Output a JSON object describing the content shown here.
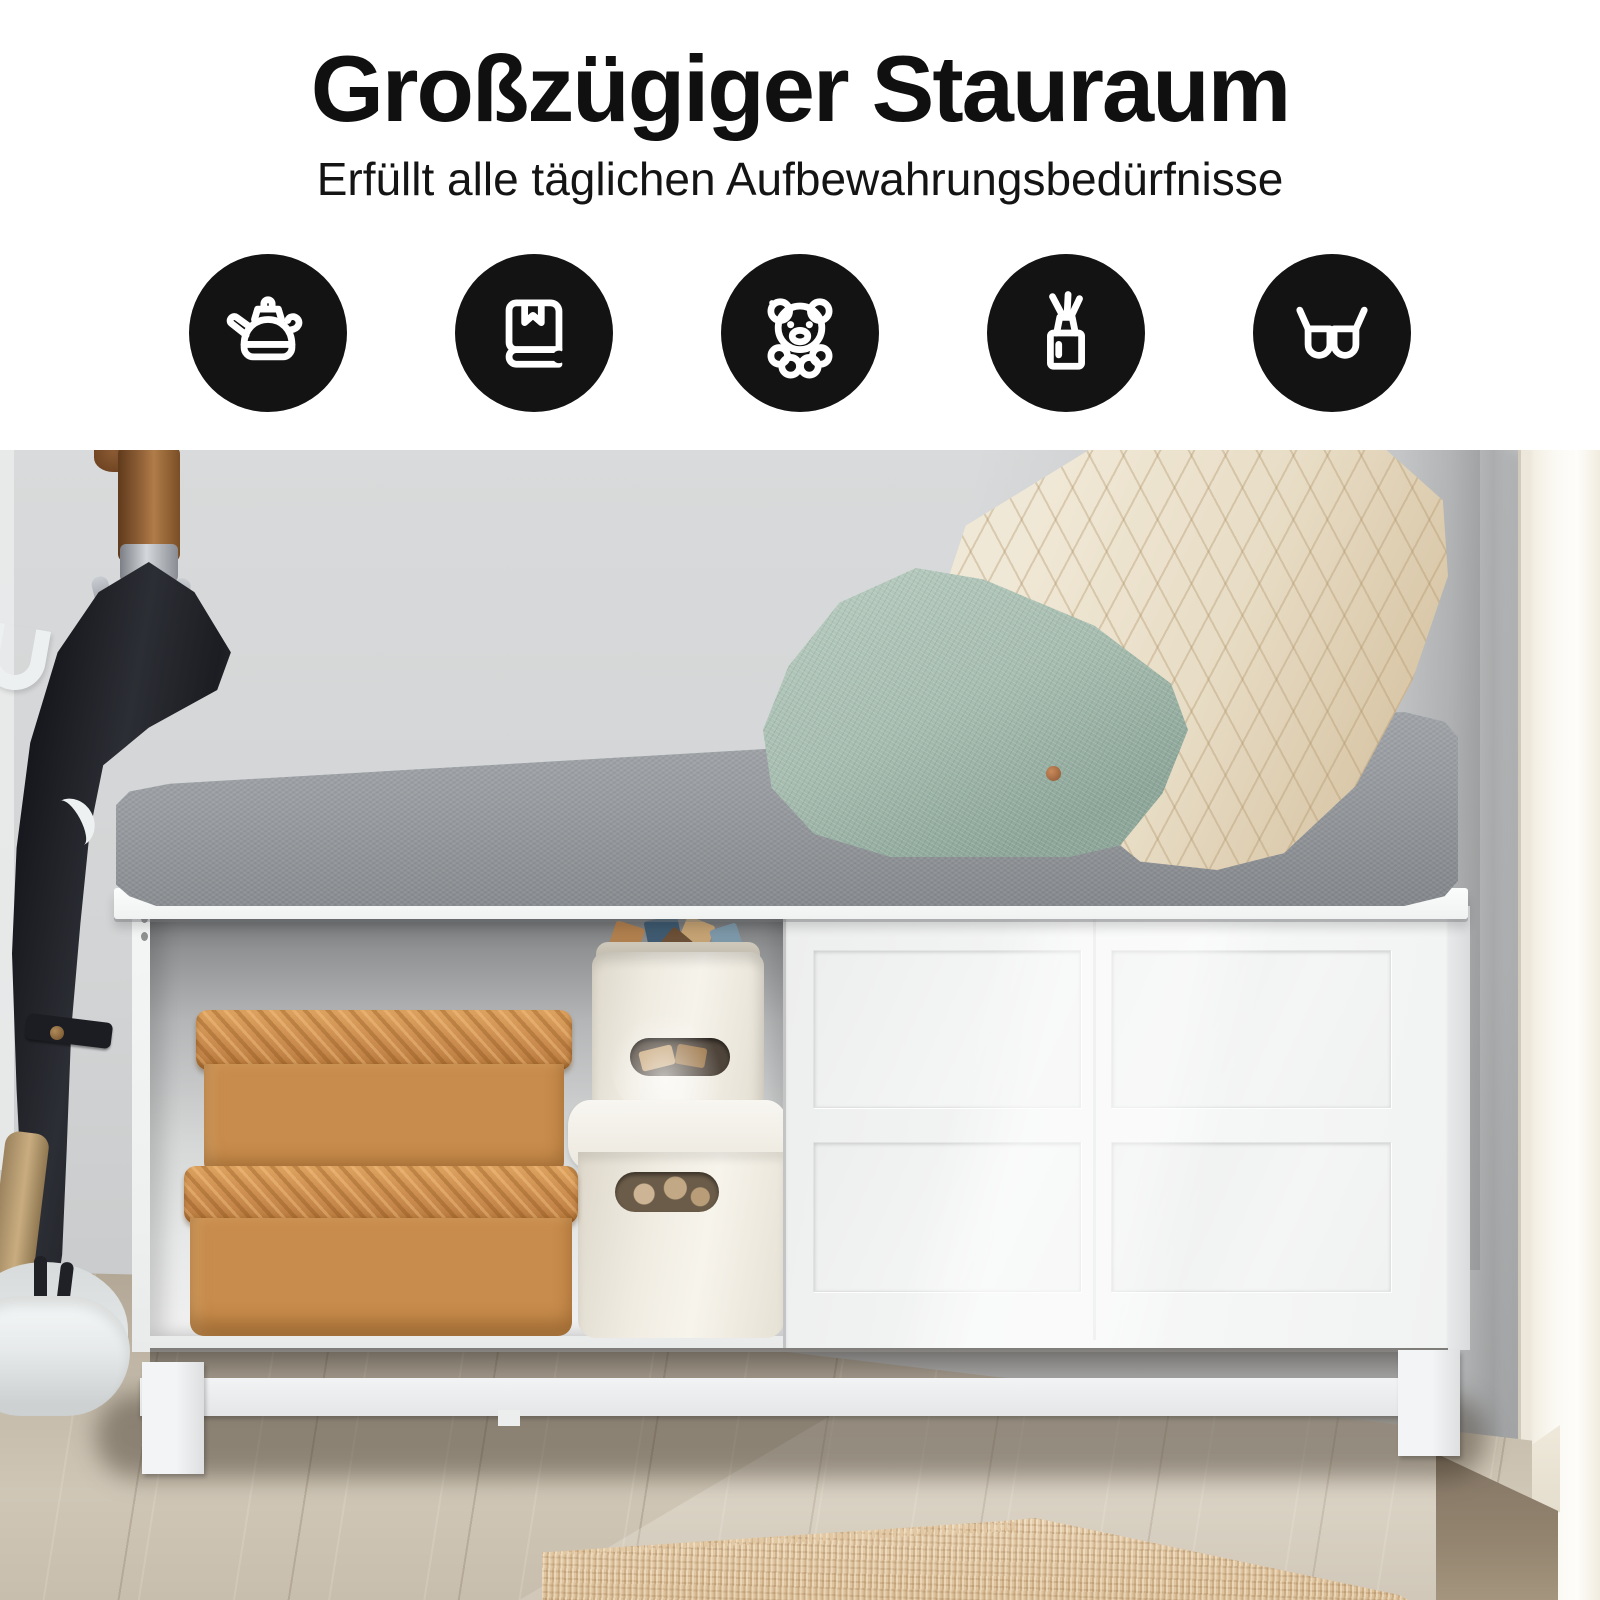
{
  "header": {
    "title": "Großzügiger Stauraum",
    "subtitle": "Erfüllt alle täglichen Aufbewahrungsbedürfnisse",
    "icons": [
      {
        "name": "kettle-icon"
      },
      {
        "name": "book-icon"
      },
      {
        "name": "teddy-bear-icon"
      },
      {
        "name": "reed-diffuser-icon"
      },
      {
        "name": "glasses-icon"
      }
    ]
  },
  "palette": {
    "page-bg": "#ffffff",
    "title-color": "#101010",
    "icon-bg": "#131313",
    "icon-fg": "#ffffff",
    "wall": "#d3d5d6",
    "trim": "#f8f5ee",
    "cushion": "#989ca0",
    "pillow-green": "#a9bfb3",
    "pillow-cream": "#e9dfcb",
    "bench-white": "#f2f3f4",
    "rattan": "#c88c4c",
    "bin-white": "#f1ede4",
    "floor-wood": "#c8beb0",
    "rug-jute": "#e2c9a6",
    "umbrella-black": "#282a30",
    "wood-handle": "#8a5730"
  }
}
